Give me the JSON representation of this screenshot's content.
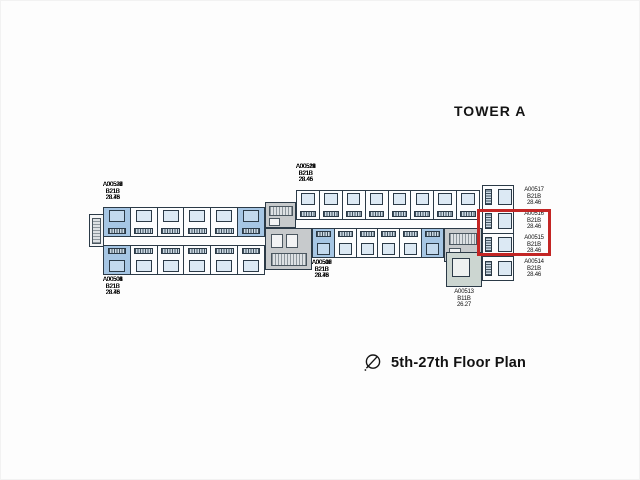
{
  "title": "TOWER A",
  "caption": "5th-27th Floor Plan",
  "tower": "A",
  "floor_range": "5th-27th",
  "colors": {
    "line": "#2b3a47",
    "wash": "#dce9f4",
    "hl": "#a6c6e4",
    "red": "#c32524",
    "core": "#c7cacc"
  },
  "highlight_box_units": [
    "A00516",
    "A00515"
  ],
  "wings": {
    "left_top": [
      {
        "id": "A00531",
        "type": "B21B",
        "area": "28.73",
        "highlighted": true
      },
      {
        "id": "A00530",
        "type": "B21B",
        "area": "28.46",
        "highlighted": false
      },
      {
        "id": "A00529",
        "type": "B21B",
        "area": "28.46",
        "highlighted": false
      },
      {
        "id": "A00528",
        "type": "B21B",
        "area": "28.46",
        "highlighted": false
      },
      {
        "id": "A00527",
        "type": "B21B",
        "area": "28.46",
        "highlighted": false
      },
      {
        "id": "A00526",
        "type": "B21B",
        "area": "28.73",
        "highlighted": true
      }
    ],
    "left_bottom": [
      {
        "id": "A00501",
        "type": "B21B",
        "area": "28.73",
        "highlighted": true
      },
      {
        "id": "A00502",
        "type": "B21B",
        "area": "28.46",
        "highlighted": false
      },
      {
        "id": "A00503",
        "type": "B21B",
        "area": "28.46",
        "highlighted": false
      },
      {
        "id": "A00504",
        "type": "B21B",
        "area": "28.46",
        "highlighted": false
      },
      {
        "id": "A00505",
        "type": "B21B",
        "area": "28.46",
        "highlighted": false
      },
      {
        "id": "A00506",
        "type": "B21B",
        "area": "28.46",
        "highlighted": false
      }
    ],
    "right_top": [
      {
        "id": "A00525",
        "type": "B21B",
        "area": "28.46",
        "highlighted": false
      },
      {
        "id": "A00524",
        "type": "B21B",
        "area": "28.46",
        "highlighted": false
      },
      {
        "id": "A00523",
        "type": "B21B",
        "area": "28.46",
        "highlighted": false
      },
      {
        "id": "A00522",
        "type": "B21B",
        "area": "28.46",
        "highlighted": false
      },
      {
        "id": "A00521",
        "type": "B21B",
        "area": "28.46",
        "highlighted": false
      },
      {
        "id": "A00520",
        "type": "B21B",
        "area": "28.46",
        "highlighted": false
      },
      {
        "id": "A00519",
        "type": "B21B",
        "area": "28.46",
        "highlighted": false
      },
      {
        "id": "A00518",
        "type": "B21B",
        "area": "28.46",
        "highlighted": false
      }
    ],
    "right_bottom": [
      {
        "id": "A00507",
        "type": "B21B",
        "area": "28.73",
        "highlighted": true
      },
      {
        "id": "A00508",
        "type": "B21B",
        "area": "28.46",
        "highlighted": false
      },
      {
        "id": "A00509",
        "type": "B21B",
        "area": "28.46",
        "highlighted": false
      },
      {
        "id": "A00510",
        "type": "B21B",
        "area": "28.46",
        "highlighted": false
      },
      {
        "id": "A00511",
        "type": "B21B",
        "area": "28.46",
        "highlighted": false
      },
      {
        "id": "A00512",
        "type": "B21B",
        "area": "28.73",
        "highlighted": true
      }
    ],
    "east_column": [
      {
        "id": "A00517",
        "type": "B21B",
        "area": "28.46",
        "highlighted": false
      },
      {
        "id": "A00516",
        "type": "B21B",
        "area": "28.46",
        "highlighted": false
      },
      {
        "id": "A00515",
        "type": "B21B",
        "area": "28.46",
        "highlighted": false
      },
      {
        "id": "A00514",
        "type": "B21B",
        "area": "28.46",
        "highlighted": false
      }
    ],
    "corner_unit": {
      "id": "A00513",
      "type": "B11B",
      "area": "26.27",
      "highlighted": false
    }
  }
}
